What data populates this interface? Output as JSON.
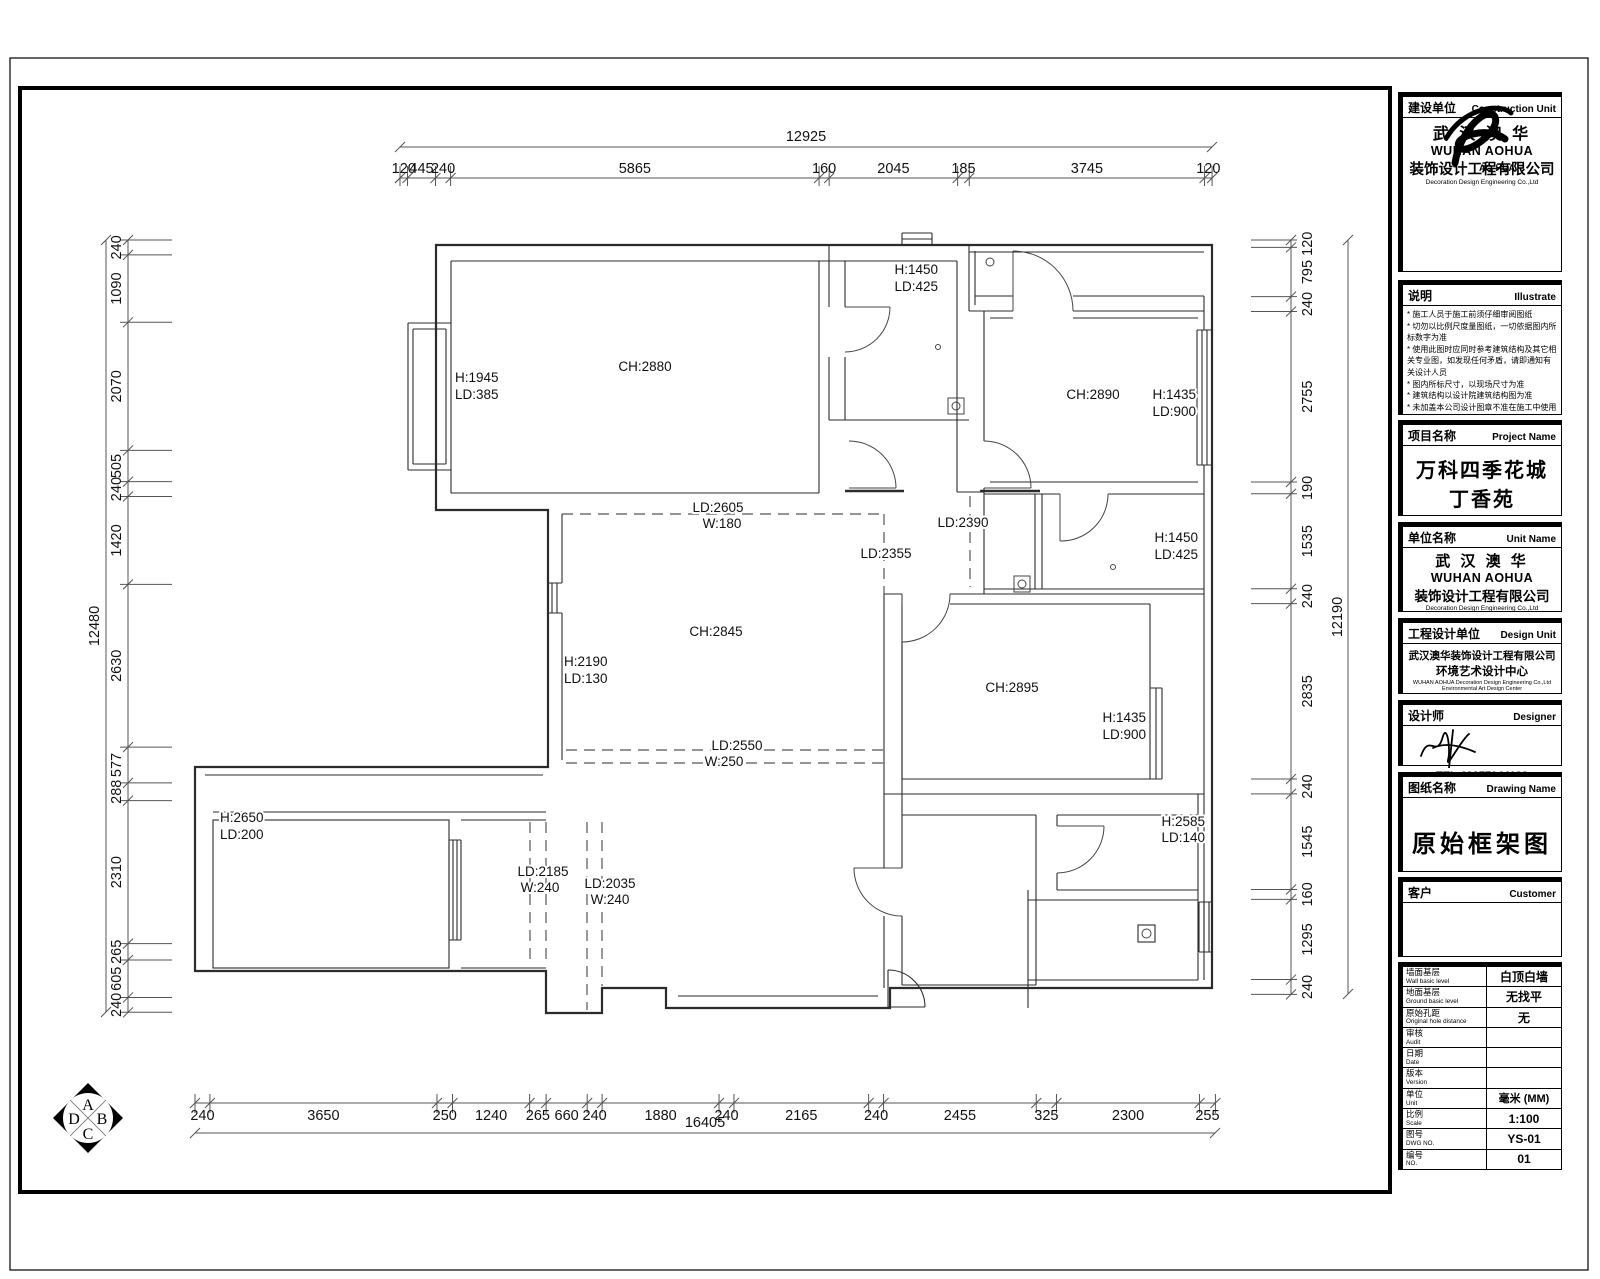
{
  "title_block": {
    "construction_unit": {
      "label_cn": "建设单位",
      "label_en": "Construction Unit",
      "logo_name": "AO-HUA",
      "company_cn": "武 汉 澳 华",
      "company_en": "WUHAN AOHUA",
      "company_cn2": "装饰设计工程有限公司",
      "company_en2": "Decoration Design Engineering Co.,Ltd"
    },
    "illustrate": {
      "label_cn": "说明",
      "label_en": "Illustrate",
      "items": [
        "施工人员于施工前须仔细审阅图纸",
        "切勿以比例尺度量图纸，一切依据图内所标数字为准",
        "使用此图时应同时参考建筑结构及其它相关专业图，如发现任何矛盾，请即通知有关设计人员",
        "图内所标尺寸，以现场尺寸为准",
        "建筑结构以设计院建筑结构图为准",
        "未加盖本公司设计图章不准在施工中使用"
      ]
    },
    "project_name": {
      "label_cn": "项目名称",
      "label_en": "Project Name",
      "line1": "万科四季花城",
      "line2": "丁香苑"
    },
    "unit_name": {
      "label_cn": "单位名称",
      "label_en": "Unit Name",
      "company_cn": "武 汉 澳 华",
      "company_en": "WUHAN AOHUA",
      "company_cn2": "装饰设计工程有限公司",
      "company_en2": "Decoration Design Engineering Co.,Ltd"
    },
    "design_unit": {
      "label_cn": "工程设计单位",
      "label_en": "Design Unit",
      "line1": "武汉澳华装饰设计工程有限公司",
      "line2": "环境艺术设计中心",
      "line3": "WUHAN AOHUA Decoration Design Engineering Co.,Ltd",
      "line4": "Environmental Art Design Center"
    },
    "designer": {
      "label_cn": "设计师",
      "label_en": "Designer",
      "tel": "TEL:13277044133"
    },
    "drawing_name": {
      "label_cn": "图纸名称",
      "label_en": "Drawing Name",
      "value": "原始框架图"
    },
    "customer": {
      "label_cn": "客户",
      "label_en": "Customer",
      "value": ""
    },
    "info_rows": [
      {
        "cn": "墙面基层",
        "en": "Wall basic level",
        "value": "白顶白墙"
      },
      {
        "cn": "地面基层",
        "en": "Ground basic level",
        "value": "无找平"
      },
      {
        "cn": "原始孔距",
        "en": "Original hole distance",
        "value": "无"
      },
      {
        "cn": "审核",
        "en": "Audit",
        "value": ""
      },
      {
        "cn": "日期",
        "en": "Date",
        "value": ""
      },
      {
        "cn": "版本",
        "en": "Version",
        "value": ""
      },
      {
        "cn": "单位",
        "en": "Unit",
        "value": "毫米 (MM)"
      },
      {
        "cn": "比例",
        "en": "Scale",
        "value": "1:100"
      },
      {
        "cn": "图号",
        "en": "DWG NO.",
        "value": "YS-01"
      },
      {
        "cn": "编号",
        "en": "NO.",
        "value": "01"
      }
    ]
  },
  "plan": {
    "compass_letters": [
      "A",
      "B",
      "C",
      "D"
    ],
    "room_labels": [
      {
        "t": "CH:2880",
        "x": 645,
        "y": 371,
        "a": "m"
      },
      {
        "t": "H:1945",
        "x": 455,
        "y": 382,
        "a": "s"
      },
      {
        "t": "LD:385",
        "x": 455,
        "y": 399,
        "a": "s"
      },
      {
        "t": "H:1450",
        "x": 938,
        "y": 274,
        "a": "e"
      },
      {
        "t": "LD:425",
        "x": 938,
        "y": 291,
        "a": "e"
      },
      {
        "t": "CH:2890",
        "x": 1093,
        "y": 399,
        "a": "m"
      },
      {
        "t": "H:1435",
        "x": 1196,
        "y": 399,
        "a": "e"
      },
      {
        "t": "LD:900",
        "x": 1196,
        "y": 416,
        "a": "e"
      },
      {
        "t": "LD:2390",
        "x": 963,
        "y": 527,
        "a": "m"
      },
      {
        "t": "LD:2355",
        "x": 886,
        "y": 558,
        "a": "m"
      },
      {
        "t": "H:1450",
        "x": 1198,
        "y": 542,
        "a": "e"
      },
      {
        "t": "LD:425",
        "x": 1198,
        "y": 559,
        "a": "e"
      },
      {
        "t": "LD:2605",
        "x": 718,
        "y": 512,
        "a": "m"
      },
      {
        "t": "W:180",
        "x": 722,
        "y": 528,
        "a": "m"
      },
      {
        "t": "CH:2845",
        "x": 716,
        "y": 636,
        "a": "m"
      },
      {
        "t": "H:2190",
        "x": 564,
        "y": 666,
        "a": "s"
      },
      {
        "t": "LD:130",
        "x": 564,
        "y": 683,
        "a": "s"
      },
      {
        "t": "LD:2550",
        "x": 737,
        "y": 750,
        "a": "m"
      },
      {
        "t": "W:250",
        "x": 724,
        "y": 766,
        "a": "m"
      },
      {
        "t": "CH:2895",
        "x": 1012,
        "y": 692,
        "a": "m"
      },
      {
        "t": "H:1435",
        "x": 1146,
        "y": 722,
        "a": "e"
      },
      {
        "t": "LD:900",
        "x": 1146,
        "y": 739,
        "a": "e"
      },
      {
        "t": "H:2650",
        "x": 220,
        "y": 822,
        "a": "s"
      },
      {
        "t": "LD:200",
        "x": 220,
        "y": 839,
        "a": "s"
      },
      {
        "t": "LD:2185",
        "x": 543,
        "y": 876,
        "a": "m"
      },
      {
        "t": "W:240",
        "x": 540,
        "y": 892,
        "a": "m"
      },
      {
        "t": "LD:2035",
        "x": 610,
        "y": 888,
        "a": "m"
      },
      {
        "t": "W:240",
        "x": 610,
        "y": 904,
        "a": "m"
      },
      {
        "t": "H:2585",
        "x": 1205,
        "y": 826,
        "a": "e"
      },
      {
        "t": "LD:140",
        "x": 1205,
        "y": 842,
        "a": "e"
      }
    ]
  },
  "dimensions": {
    "top": {
      "overall": "12925",
      "segments": [
        120,
        445,
        240,
        5865,
        160,
        2045,
        185,
        3745,
        120
      ]
    },
    "bottom": {
      "overall": "16405",
      "segments": [
        240,
        3650,
        250,
        1240,
        265,
        660,
        240,
        1880,
        240,
        2165,
        240,
        2455,
        325,
        2300,
        255
      ]
    },
    "left": {
      "overall": "12480",
      "segments": [
        240,
        1090,
        2070,
        505,
        240,
        1420,
        2630,
        577,
        288,
        2310,
        265,
        605,
        240
      ]
    },
    "right": {
      "overall": "12190",
      "segments": [
        120,
        795,
        240,
        2755,
        190,
        1535,
        240,
        2835,
        240,
        1545,
        160,
        1295,
        240
      ]
    }
  }
}
